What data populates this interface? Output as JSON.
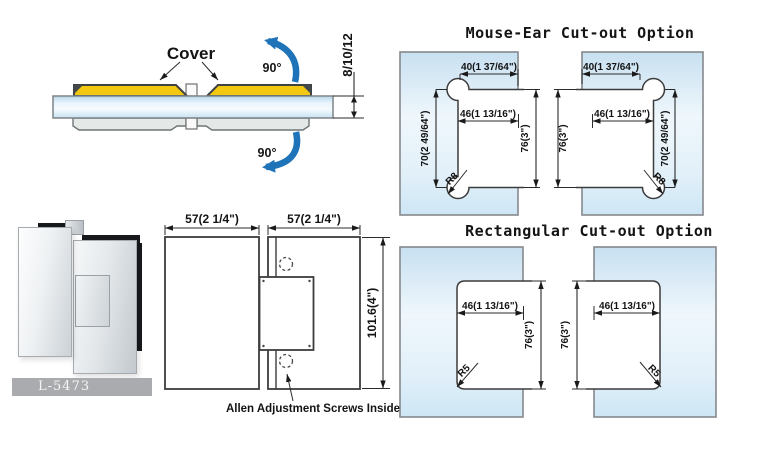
{
  "side_view": {
    "cover_label": "Cover",
    "angle_top_label": "90°",
    "angle_bottom_label": "90°",
    "glass_thickness": "8/10/12"
  },
  "product_photo": {
    "model_code": "L-5473"
  },
  "front_view": {
    "dim_width_left": "57(2 1/4\")",
    "dim_width_right": "57(2 1/4\")",
    "dim_height": "101.6(4\")",
    "note": "Allen Adjustment Screws Inside"
  },
  "mouse_ear_option": {
    "title": "Mouse-Ear Cut-out Option",
    "dim_top_width": "40(1 37/64\")",
    "dim_inner_width": "46(1 13/16\")",
    "dim_ear_distance": "70(2 49/64\")",
    "dim_cutout_height": "76(3\")",
    "corner_radius": "R8"
  },
  "rectangular_option": {
    "title": "Rectangular Cut-out Option",
    "dim_inner_width": "46(1 13/16\")",
    "dim_cutout_height": "76(3\")",
    "corner_radius": "R5"
  },
  "colors": {
    "glass_blue": "#c9e1f2",
    "cover_yellow": "#f2c811",
    "arrow_blue": "#1e73b9",
    "line_dark": "#3c3c3c",
    "clamp_gray": "#e4e8e7",
    "banner_gray": "#a9abae"
  }
}
